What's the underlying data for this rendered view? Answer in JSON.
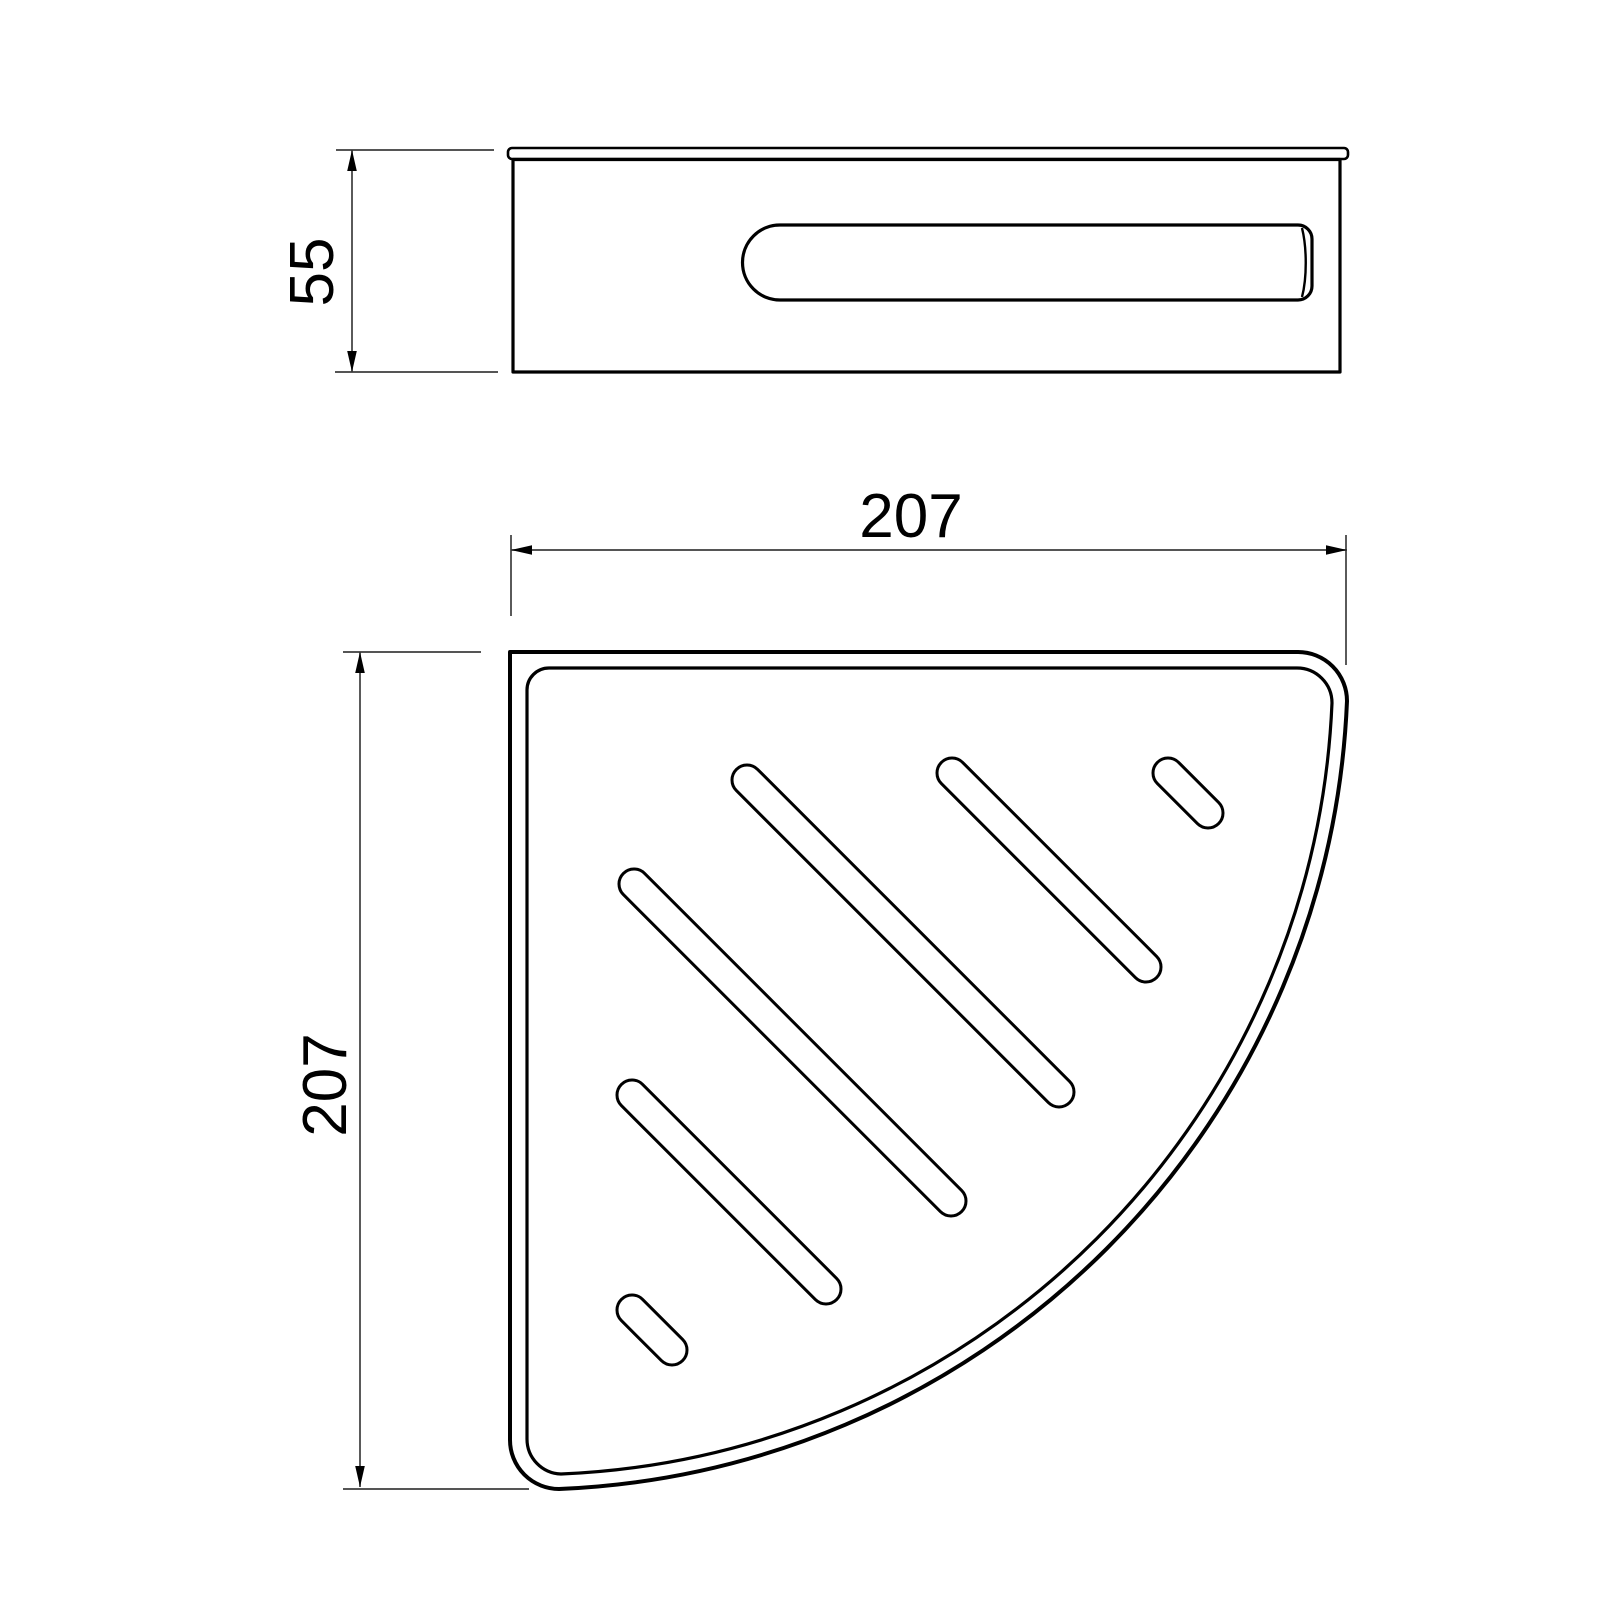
{
  "drawing": {
    "kind": "orthographic technical drawing",
    "colors": {
      "background": "#ffffff",
      "outline": "#000000",
      "dimension_lines": "#3d3d3d",
      "dimension_text": "#000000"
    },
    "dimensions": {
      "side_height": "55",
      "plan_width": "207",
      "plan_depth": "207"
    },
    "plan_slots": [
      {
        "x": 747,
        "y": 780,
        "run": 312,
        "r": 15
      },
      {
        "x": 952,
        "y": 773,
        "run": 194,
        "r": 15
      },
      {
        "x": 1168,
        "y": 773,
        "run": 40,
        "r": 15
      },
      {
        "x": 634,
        "y": 884,
        "run": 317,
        "r": 15
      },
      {
        "x": 632,
        "y": 1095,
        "run": 194,
        "r": 15
      },
      {
        "x": 632,
        "y": 1310,
        "run": 40,
        "r": 15
      }
    ]
  }
}
